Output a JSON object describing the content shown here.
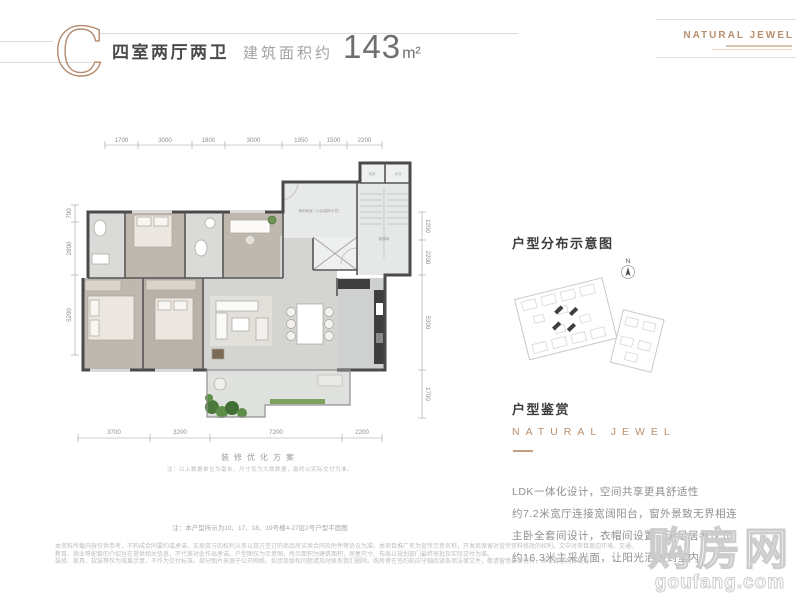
{
  "header": {
    "letter": "C",
    "unit_type": "四室两厅两卫",
    "area_label": "建筑面积约",
    "area_number": "143",
    "area_unit": "m²",
    "brand": "NATURAL JEWEL"
  },
  "floorplan": {
    "dims_top": [
      "1700",
      "3000",
      "1800",
      "3000",
      "1950",
      "1500",
      "2200"
    ],
    "dims_bottom": [
      "3700",
      "3200",
      "7200",
      "2200"
    ],
    "dims_left": [
      "700",
      "2800",
      "5200"
    ],
    "dims_right": [
      "1200",
      "2200",
      "5300",
      "1700"
    ],
    "room_labels": {
      "entry": "梯间前室（公区装修示意）",
      "stair": "楼梯间",
      "shaft_left": "电井",
      "shaft_right": "水井"
    },
    "caption": "装修优化方案",
    "caption_note": "注：以上数据单位为毫米，尺寸仅为大致数据，最终以实际交付为准。",
    "plan_note": "注：本户型所示为10、17、18、19号楼4-27层2号户型平面图"
  },
  "sidebar": {
    "distribution_title": "户型分布示意图",
    "compass_label": "N",
    "appreciation_title": "户型鉴赏",
    "brand_caption": "NATURAL JEWEL",
    "paragraphs": [
      "LDK一体化设计，空间共享更具舒适性",
      "约7.2米宽厅连接宽阔阳台，窗外景致无界相连",
      "主卧全套间设计，衣帽间设置，满足居者仪式",
      "约16.3米主采光面，让阳光洒满到室内"
    ]
  },
  "watermark": {
    "name": "购房网",
    "site": "goufang.com"
  },
  "fineprint": {
    "line1": "本资料所载内容仅供参考，不构成合同要约或承诺，买卖双方的权利义务以双方签订的商品房买卖合同及附件等协议为准。本项目推广名为宣传示意名称，开发商保留对宣传资料修改的权利。文中对项目周边环境、交通、教育、商业等配套的介绍旨在提供相关信息，不代表对此作出承诺。户型图仅为示意图，所示面积为建筑面积，房屋尺寸、布局以规划部门最终审批及实际交付为准。",
    "line2": "装修、家具、软装等仅为效果示意，不作为交付标准。部分图片来源于公开网络，如涉及版权问题请及时联系我们删除。购房者在签约前应仔细阅读各项法律文件，敬请留意最新资料，详情请垂询售楼处。"
  }
}
